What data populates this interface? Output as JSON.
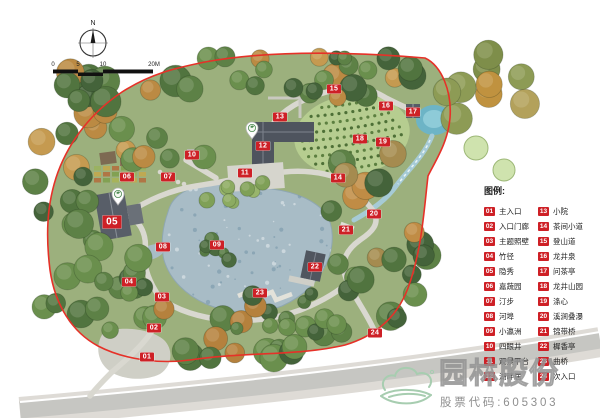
{
  "compass": {
    "north_label": "N"
  },
  "scale_bar": {
    "ticks": [
      "0",
      "5",
      "10",
      "20M"
    ]
  },
  "legend": {
    "title": "图例:",
    "columns": [
      {
        "items": [
          {
            "num": "01",
            "label": "主入口"
          },
          {
            "num": "02",
            "label": "入口门廊"
          },
          {
            "num": "03",
            "label": "主题照壁"
          },
          {
            "num": "04",
            "label": "竹径"
          },
          {
            "num": "05",
            "label": "隐秀"
          },
          {
            "num": "06",
            "label": "嘉蔬园"
          },
          {
            "num": "07",
            "label": "汀步"
          },
          {
            "num": "08",
            "label": "河埠"
          },
          {
            "num": "09",
            "label": "小瀛洲"
          },
          {
            "num": "10",
            "label": "四眼井"
          },
          {
            "num": "11",
            "label": "观景平台"
          },
          {
            "num": "12",
            "label": "湖畔居"
          }
        ]
      },
      {
        "items": [
          {
            "num": "13",
            "label": "小院"
          },
          {
            "num": "14",
            "label": "茶间小道"
          },
          {
            "num": "15",
            "label": "登山道"
          },
          {
            "num": "16",
            "label": "龙井泉"
          },
          {
            "num": "17",
            "label": "问茶亭"
          },
          {
            "num": "18",
            "label": "龙井山园"
          },
          {
            "num": "19",
            "label": "涤心"
          },
          {
            "num": "20",
            "label": "溪涧叠瀑"
          },
          {
            "num": "21",
            "label": "锦带桥"
          },
          {
            "num": "22",
            "label": "樨香亭"
          },
          {
            "num": "23",
            "label": "曲桥"
          },
          {
            "num": "24",
            "label": "次入口"
          }
        ]
      }
    ]
  },
  "plan": {
    "markers": [
      {
        "num": "01",
        "x": 147,
        "y": 357
      },
      {
        "num": "02",
        "x": 154,
        "y": 328
      },
      {
        "num": "03",
        "x": 162,
        "y": 297
      },
      {
        "num": "04",
        "x": 129,
        "y": 282
      },
      {
        "num": "05",
        "x": 112,
        "y": 222,
        "size": "lg"
      },
      {
        "num": "06",
        "x": 127,
        "y": 177
      },
      {
        "num": "07",
        "x": 168,
        "y": 177
      },
      {
        "num": "08",
        "x": 163,
        "y": 247
      },
      {
        "num": "09",
        "x": 217,
        "y": 245
      },
      {
        "num": "10",
        "x": 192,
        "y": 155
      },
      {
        "num": "11",
        "x": 245,
        "y": 173
      },
      {
        "num": "12",
        "x": 263,
        "y": 146
      },
      {
        "num": "13",
        "x": 280,
        "y": 117
      },
      {
        "num": "14",
        "x": 338,
        "y": 178
      },
      {
        "num": "15",
        "x": 334,
        "y": 89
      },
      {
        "num": "16",
        "x": 386,
        "y": 106
      },
      {
        "num": "17",
        "x": 413,
        "y": 112
      },
      {
        "num": "18",
        "x": 360,
        "y": 139
      },
      {
        "num": "19",
        "x": 383,
        "y": 142
      },
      {
        "num": "20",
        "x": 374,
        "y": 214
      },
      {
        "num": "21",
        "x": 346,
        "y": 230
      },
      {
        "num": "22",
        "x": 315,
        "y": 267
      },
      {
        "num": "23",
        "x": 260,
        "y": 293
      },
      {
        "num": "24",
        "x": 375,
        "y": 333
      }
    ],
    "pins": [
      {
        "x": 118,
        "y": 204
      },
      {
        "x": 252,
        "y": 138
      }
    ]
  },
  "watermark": {
    "company": "园林股份",
    "stock_code": "股票代码:605303"
  },
  "colors": {
    "boundary": "#e63128",
    "marker_bg": "#ce2026",
    "water": "#a8bcc6",
    "spring_pool": "#6db4c6",
    "terrace": "#b6cd90",
    "logo_green": "#a7cdb0"
  }
}
